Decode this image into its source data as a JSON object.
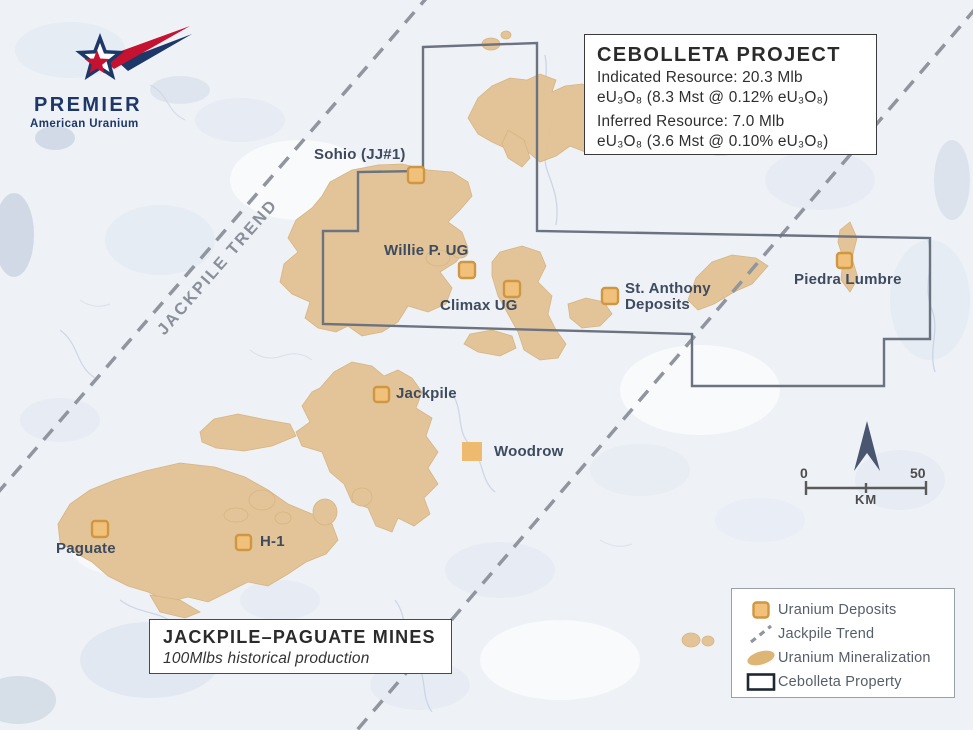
{
  "logo": {
    "name": "PREMIER",
    "tagline": "American Uranium"
  },
  "info_box": {
    "title": "CEBOLLETA PROJECT",
    "indicated_line1": "Indicated Resource: 20.3 Mlb",
    "indicated_line2": "eU₃O₈ (8.3 Mst @ 0.12% eU₃O₈)",
    "inferred_line1": "Inferred Resource: 7.0 Mlb",
    "inferred_line2": "eU₃O₈ (3.6 Mst @ 0.10% eU₃O₈)"
  },
  "trend_label": "JACKPILE TREND",
  "mines_box": {
    "title": "JACKPILE–PAGUATE MINES",
    "subtitle": "100Mlbs historical production"
  },
  "map_labels": {
    "sohio": "Sohio (JJ#1)",
    "willie": "Willie P. UG",
    "climax": "Climax UG",
    "st_anthony": "St. Anthony Deposits",
    "piedra_lumbre": "Piedra Lumbre",
    "jackpile": "Jackpile",
    "woodrow": "Woodrow",
    "h1": "H-1",
    "paguate": "Paguate"
  },
  "legend": {
    "items": [
      {
        "label": "Uranium Deposits",
        "icon": "uranium-deposit-square-icon"
      },
      {
        "label": "Jackpile Trend",
        "icon": "dashed-trend-line-icon"
      },
      {
        "label": "Uranium Mineralization",
        "icon": "mineralization-blob-icon"
      },
      {
        "label": "Cebolleta Property",
        "icon": "property-boundary-icon"
      }
    ]
  },
  "scale_bar": {
    "start": "0",
    "end": "50",
    "unit": "KM"
  },
  "colors": {
    "deposit_fill": "#f1c07a",
    "deposit_border": "#cf9742",
    "mineralization": "#e2c293",
    "property_boundary": "#6b7280",
    "trend_line": "#90959e",
    "label_text": "#3e4b5e",
    "logo_navy": "#1c3768",
    "logo_red": "#c41230",
    "map_background": "#eef1f6"
  }
}
